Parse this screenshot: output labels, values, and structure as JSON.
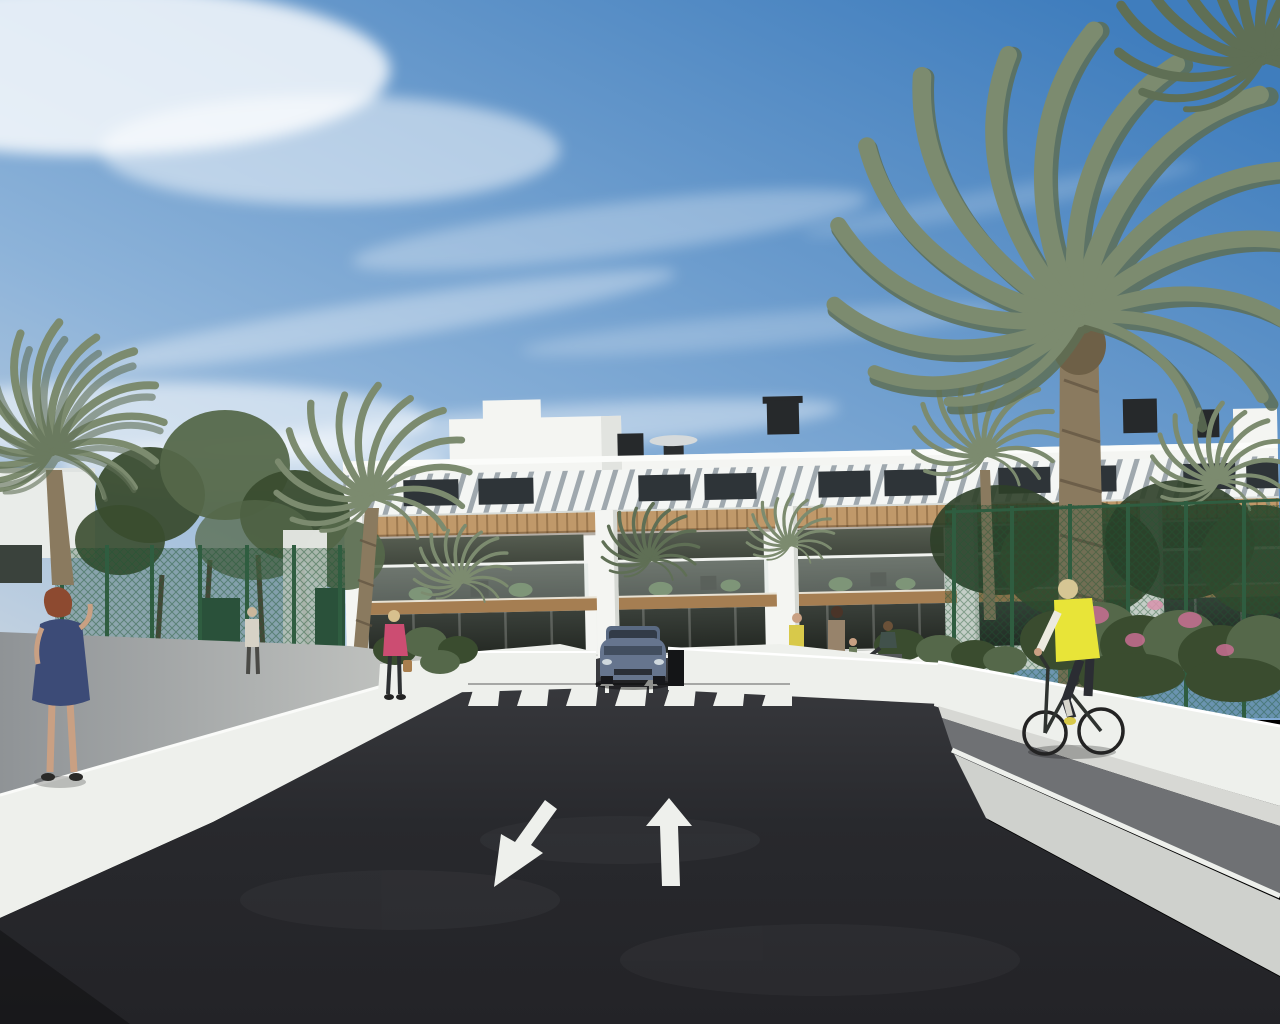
{
  "meta": {
    "title": "New-build apartment complex street view — sunny CGI render",
    "type": "architectural-visualization",
    "dimensions": {
      "width": 1280,
      "height": 1024
    }
  },
  "palette": {
    "sky_top": "#3f7dbd",
    "sky_mid": "#8db3d9",
    "sky_horizon": "#ccd7e2",
    "cloud_white": "#ffffff",
    "building_white": "#f4f5f2",
    "building_shade": "#e2e4e0",
    "roof_slat_gray": "#9fa8ae",
    "clerestory_dark": "#2e3438",
    "pergola_wood": "#c0996a",
    "wood_dark": "#a57e52",
    "glazing_dark": "#333a33",
    "glass_rail": "#cfdeda",
    "wall_white": "#eef0ec",
    "sidewalk_gray": "#a6a9a9",
    "bike_path_gray": "#6f7174",
    "asphalt_dark": "#2a2b2f",
    "marking_white": "#eef0ec",
    "fence_green": "#2f5d40",
    "foliage_dark": "#3a4c2f",
    "foliage_mid": "#55684a",
    "palm_green": "#7c8b6f",
    "palm_dark": "#5f6f55",
    "palm_trunk": "#8a7a5f",
    "flower_pink": "#c76e92",
    "car_body_blue": "#66758e",
    "car_glass": "#323b47",
    "dress_blue": "#3c4b77",
    "hair_auburn": "#8d4a30",
    "jacket_pink": "#cc4d72",
    "vest_yellow": "#e8e438",
    "skin_tone": "#c9a083",
    "bike_frame": "#2f3330"
  },
  "scene": {
    "setting": "sunny residential street ending at an underground garage ramp of a new apartment block",
    "sky": {
      "condition": "blue sky with wispy cirrus clouds"
    },
    "building": {
      "kind": "modern white apartment block",
      "storeys": 2,
      "units_visible": 5,
      "features": [
        "stepped white penthouse volumes",
        "slatted sloped roof with dark clerestory windows",
        "timber pergola sunshades",
        "glass-balustrade balconies with plants and chairs",
        "dark floor-to-ceiling glazing",
        "white planter walls",
        "rooftop chimneys, vent boxes and a disc light"
      ],
      "left_fragment": "distant white building seen through trees on far left"
    },
    "road": {
      "surface": "dark asphalt",
      "lane_arrows": [
        {
          "direction": "down-left",
          "meaning": "lane toward viewer"
        },
        {
          "direction": "up",
          "meaning": "lane away from viewer"
        }
      ],
      "small_ramp_arrows": 2,
      "zebra_crossing": {
        "stripes": 7
      },
      "garage_ramp": "center, flanked by white retaining walls",
      "right_side": "white wall, light path, gray cycle strip with white edge line"
    },
    "vehicles": [
      {
        "type": "SUV",
        "color": "blue-gray",
        "position": "coming down the ramp behind the zebra crossing",
        "bollard": "black post at its right"
      }
    ],
    "people": [
      {
        "id": "woman-blue-dress",
        "desc": "red-haired woman in a blue dress walking away on the left sidewalk"
      },
      {
        "id": "woman-pink-jacket",
        "desc": "blonde woman in a pink jacket carrying a handbag on the left path"
      },
      {
        "id": "distant-pedestrian",
        "desc": "distant pedestrian in light clothes on the left path"
      },
      {
        "id": "person-yellow-top",
        "desc": "person in a yellow top by the building terrace"
      },
      {
        "id": "adult-with-child",
        "desc": "adult standing with a small child by the planters"
      },
      {
        "id": "seated-person",
        "desc": "person seated at the terrace edge"
      },
      {
        "id": "cyclist",
        "desc": "blonde cyclist in a yellow vest riding the right-side path toward the building"
      }
    ],
    "vegetation": {
      "palm_trees": 9,
      "deciduous_trees": 4,
      "shrubs": "green borders with pink flowering bushes on the right",
      "fences": [
        "dark green mesh fence with solid panels on the left",
        "green mesh fence with posts on the right"
      ]
    }
  }
}
